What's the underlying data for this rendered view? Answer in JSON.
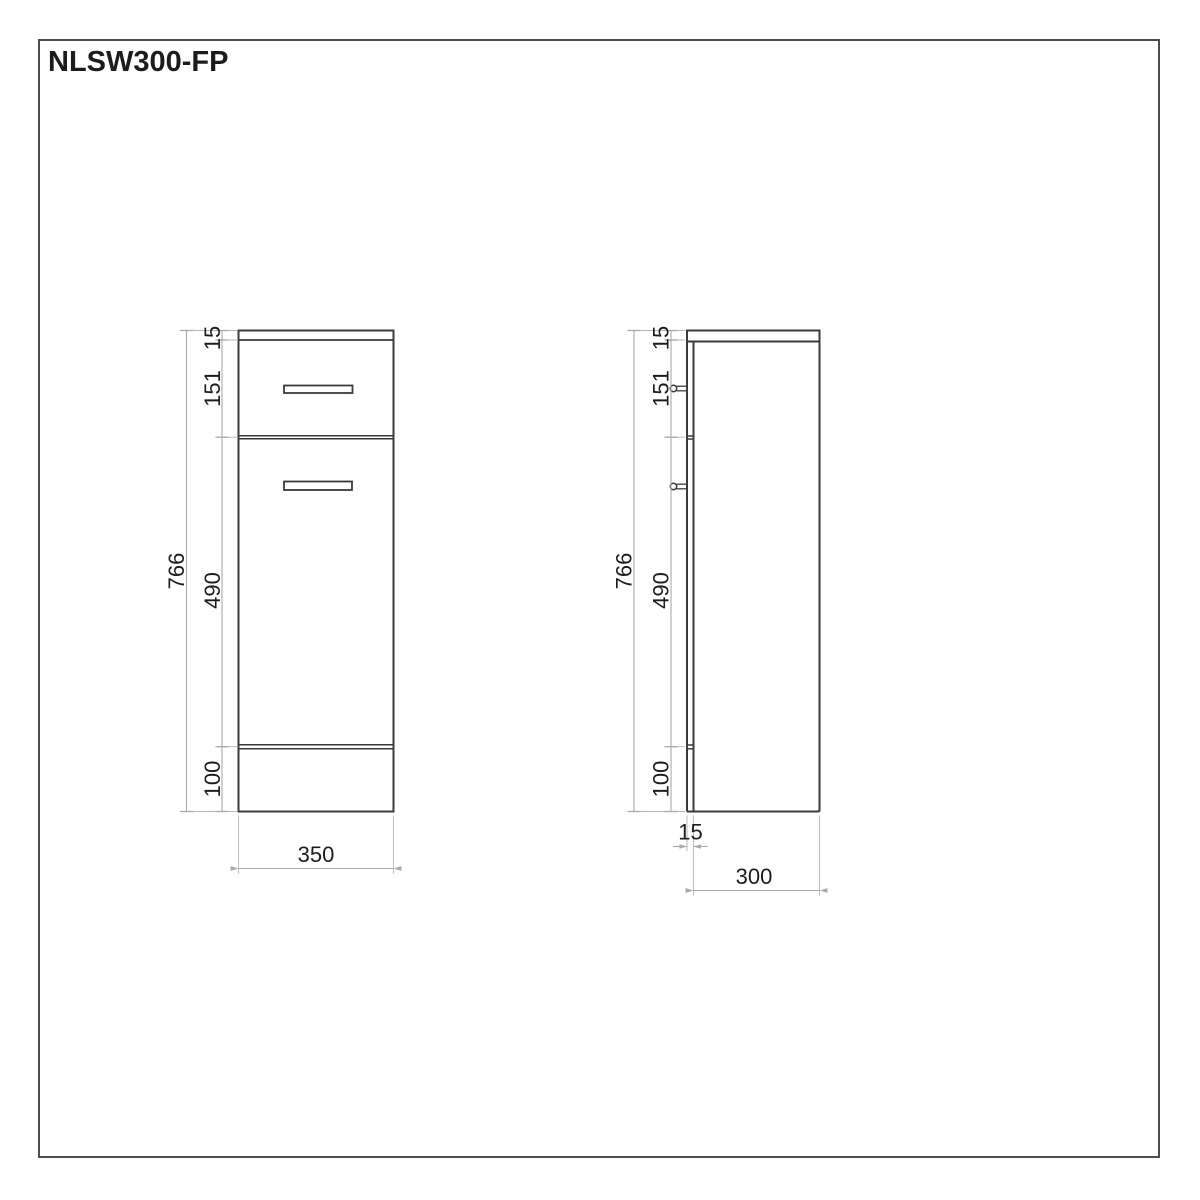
{
  "title": "NLSW300-FP",
  "front_view": {
    "top_thickness": "15",
    "drawer_height": "151",
    "door_height": "490",
    "plinth_height": "100",
    "total_height": "766",
    "width": "350"
  },
  "side_view": {
    "top_thickness": "15",
    "drawer_height": "151",
    "door_height": "490",
    "plinth_height": "100",
    "total_height": "766",
    "door_thickness": "15",
    "depth": "300"
  },
  "colors": {
    "bg": "#ffffff",
    "outline": "#3b3b3b",
    "dim": "#a9a9a9",
    "text": "#1c1c1c",
    "frame": "#4d4d4d"
  }
}
